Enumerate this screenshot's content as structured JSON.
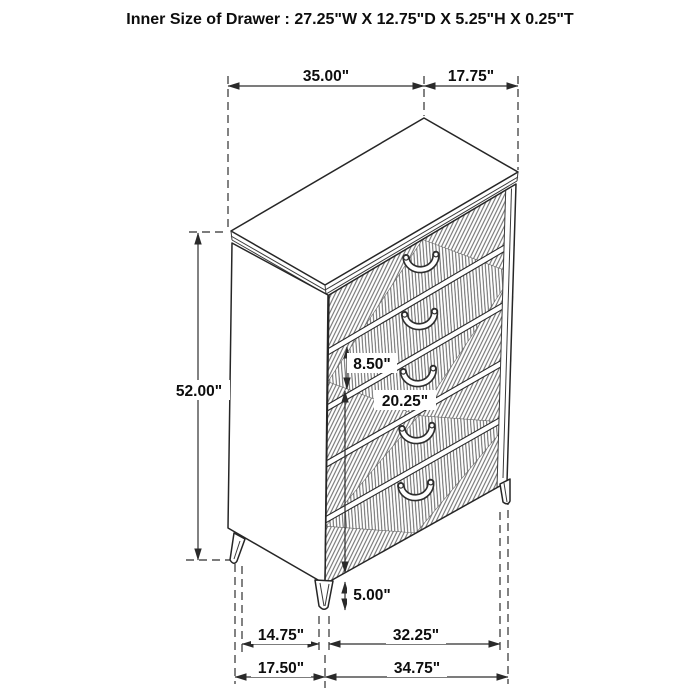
{
  "title": "Inner Size of Drawer : 27.25\"W X 12.75\"D X 5.25\"H X 0.25\"T",
  "figure": {
    "drawer_count": 5
  },
  "dimensions": {
    "top_width": "35.00\"",
    "top_depth": "17.75\"",
    "overall_height": "52.00\"",
    "drawer_front_height": "8.50\"",
    "lower_drawer_section_height": "20.25\"",
    "leg_height": "5.00\"",
    "base_inner_depth": "14.75\"",
    "base_inner_width": "32.25\"",
    "base_outer_depth": "17.50\"",
    "base_outer_width": "34.75\""
  }
}
